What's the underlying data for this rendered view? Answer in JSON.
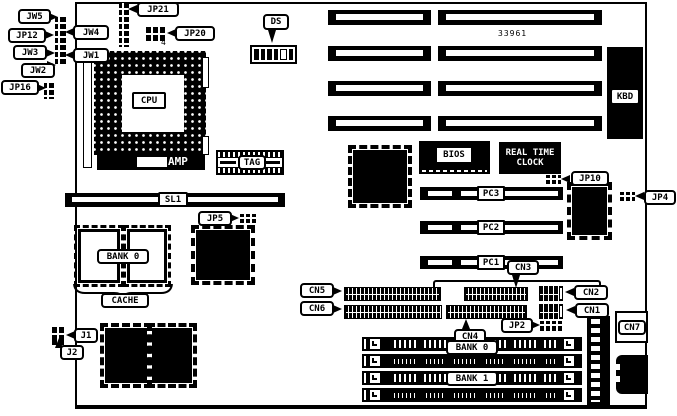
{
  "colors": {
    "foreground": "#000000",
    "background": "#ffffff"
  },
  "board": {
    "part_number": "33961"
  },
  "labels": {
    "jw5": "JW5",
    "jw4": "JW4",
    "jp12": "JP12",
    "jw3": "JW3",
    "jw1": "JW1",
    "jw2": "JW2",
    "jp16": "JP16",
    "jp21": "JP21",
    "jp20": "JP20",
    "jp20_pin4": "4",
    "ds": "DS",
    "cpu": "CPU",
    "amp": "AMP",
    "tag": "TAG",
    "sl1": "SL1",
    "jp5": "JP5",
    "cache_bank0": "BANK 0",
    "cache": "CACHE",
    "j1": "J1",
    "j2": "J2",
    "bios": "BIOS",
    "rtc_line1": "REAL TIME",
    "rtc_line2": "CLOCK",
    "jp10": "JP10",
    "jp4": "JP4",
    "kbd": "KBD",
    "pc3": "PC3",
    "pc2": "PC2",
    "pc1": "PC1",
    "cn3": "CN3",
    "cn5": "CN5",
    "cn6": "CN6",
    "cn4": "CN4",
    "jp2": "JP2",
    "cn2": "CN2",
    "cn1": "CN1",
    "cn7": "CN7",
    "mem_bank0": "BANK 0",
    "mem_bank1": "BANK 1"
  }
}
